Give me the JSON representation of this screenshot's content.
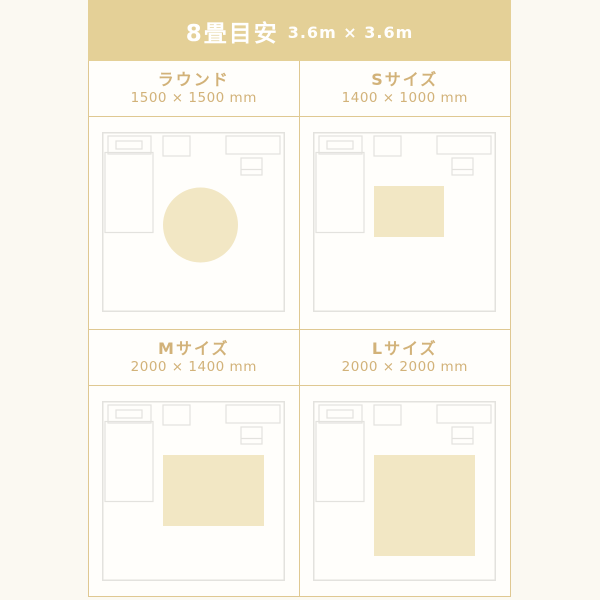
{
  "header": {
    "title": "8畳目安",
    "room_dimensions": "3.6m × 3.6m"
  },
  "colors": {
    "band_background": "#e4d097",
    "accent_line": "#dfc892",
    "accent_text": "#d2b279",
    "rug_fill": "#f2e7c4",
    "room_stroke": "#e3e2de"
  },
  "room_scale": {
    "room_width_px": 183,
    "room_height_px": 180
  },
  "cells": [
    {
      "id": "round",
      "label": "ラウンド",
      "size": "1500 × 1500 mm",
      "rug": {
        "shape": "circle",
        "cx": 98.5,
        "cy": 93,
        "r": 37.5
      }
    },
    {
      "id": "s",
      "label": "Sサイズ",
      "size": "1400 × 1000 mm",
      "rug": {
        "shape": "rect",
        "x": 61,
        "y": 54,
        "w": 70,
        "h": 51
      }
    },
    {
      "id": "m",
      "label": "Mサイズ",
      "size": "2000 × 1400 mm",
      "rug": {
        "shape": "rect",
        "x": 61,
        "y": 54,
        "w": 101,
        "h": 71
      }
    },
    {
      "id": "l",
      "label": "Lサイズ",
      "size": "2000 × 2000 mm",
      "rug": {
        "shape": "rect",
        "x": 61,
        "y": 54,
        "w": 101,
        "h": 101
      }
    }
  ]
}
